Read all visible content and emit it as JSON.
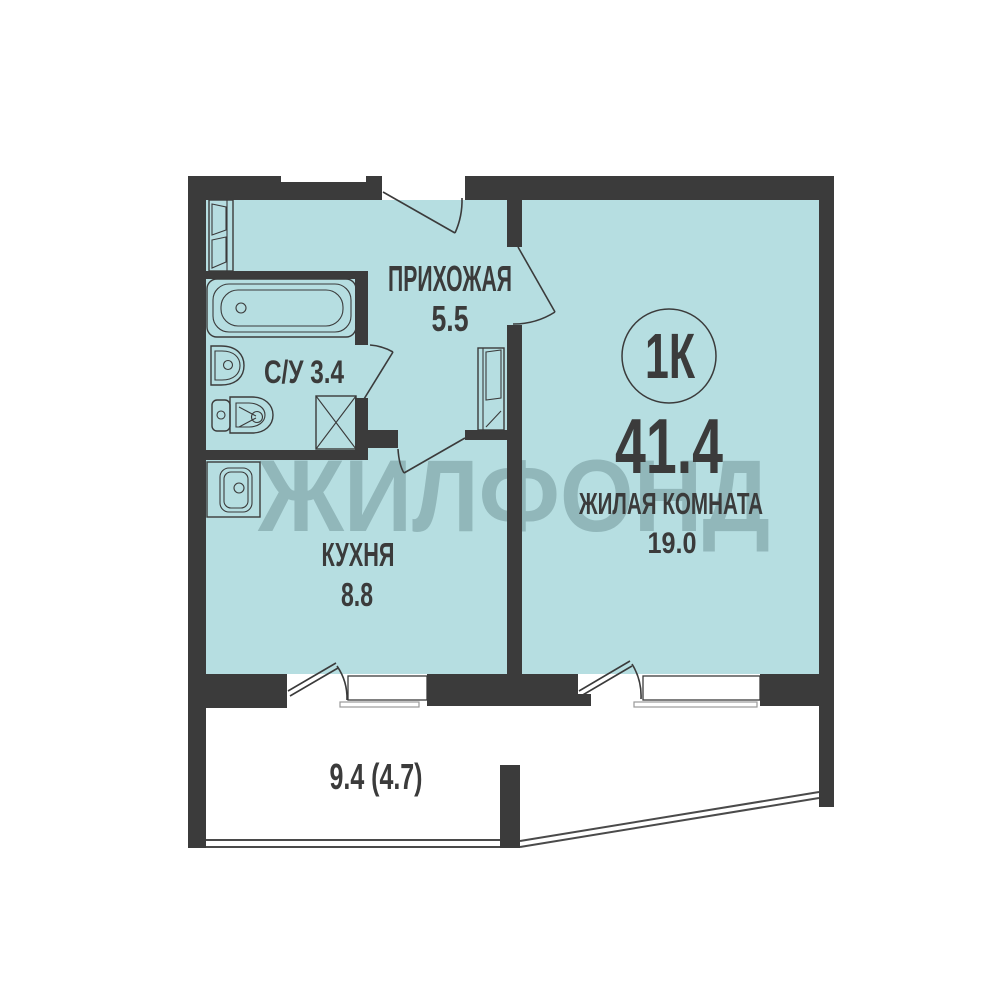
{
  "plan": {
    "watermark": "ЖИЛФОНД",
    "badge": {
      "apartment_type": "1К",
      "total_area": "41.4"
    },
    "rooms": {
      "hallway": {
        "name": "ПРИХОЖАЯ",
        "area": "5.5"
      },
      "bathroom": {
        "label": "С/У 3.4"
      },
      "kitchen": {
        "name": "КУХНЯ",
        "area": "8.8"
      },
      "living_room": {
        "name": "ЖИЛАЯ КОМНАТА",
        "area": "19.0"
      },
      "balcony": {
        "area_label": "9.4 (4.7)"
      }
    },
    "colors": {
      "wall": "#3b3b3b",
      "floor_fill": "#b6dee1",
      "watermark": "#90b5b8",
      "label_text": "#3b3b3b",
      "background": "#ffffff"
    }
  }
}
